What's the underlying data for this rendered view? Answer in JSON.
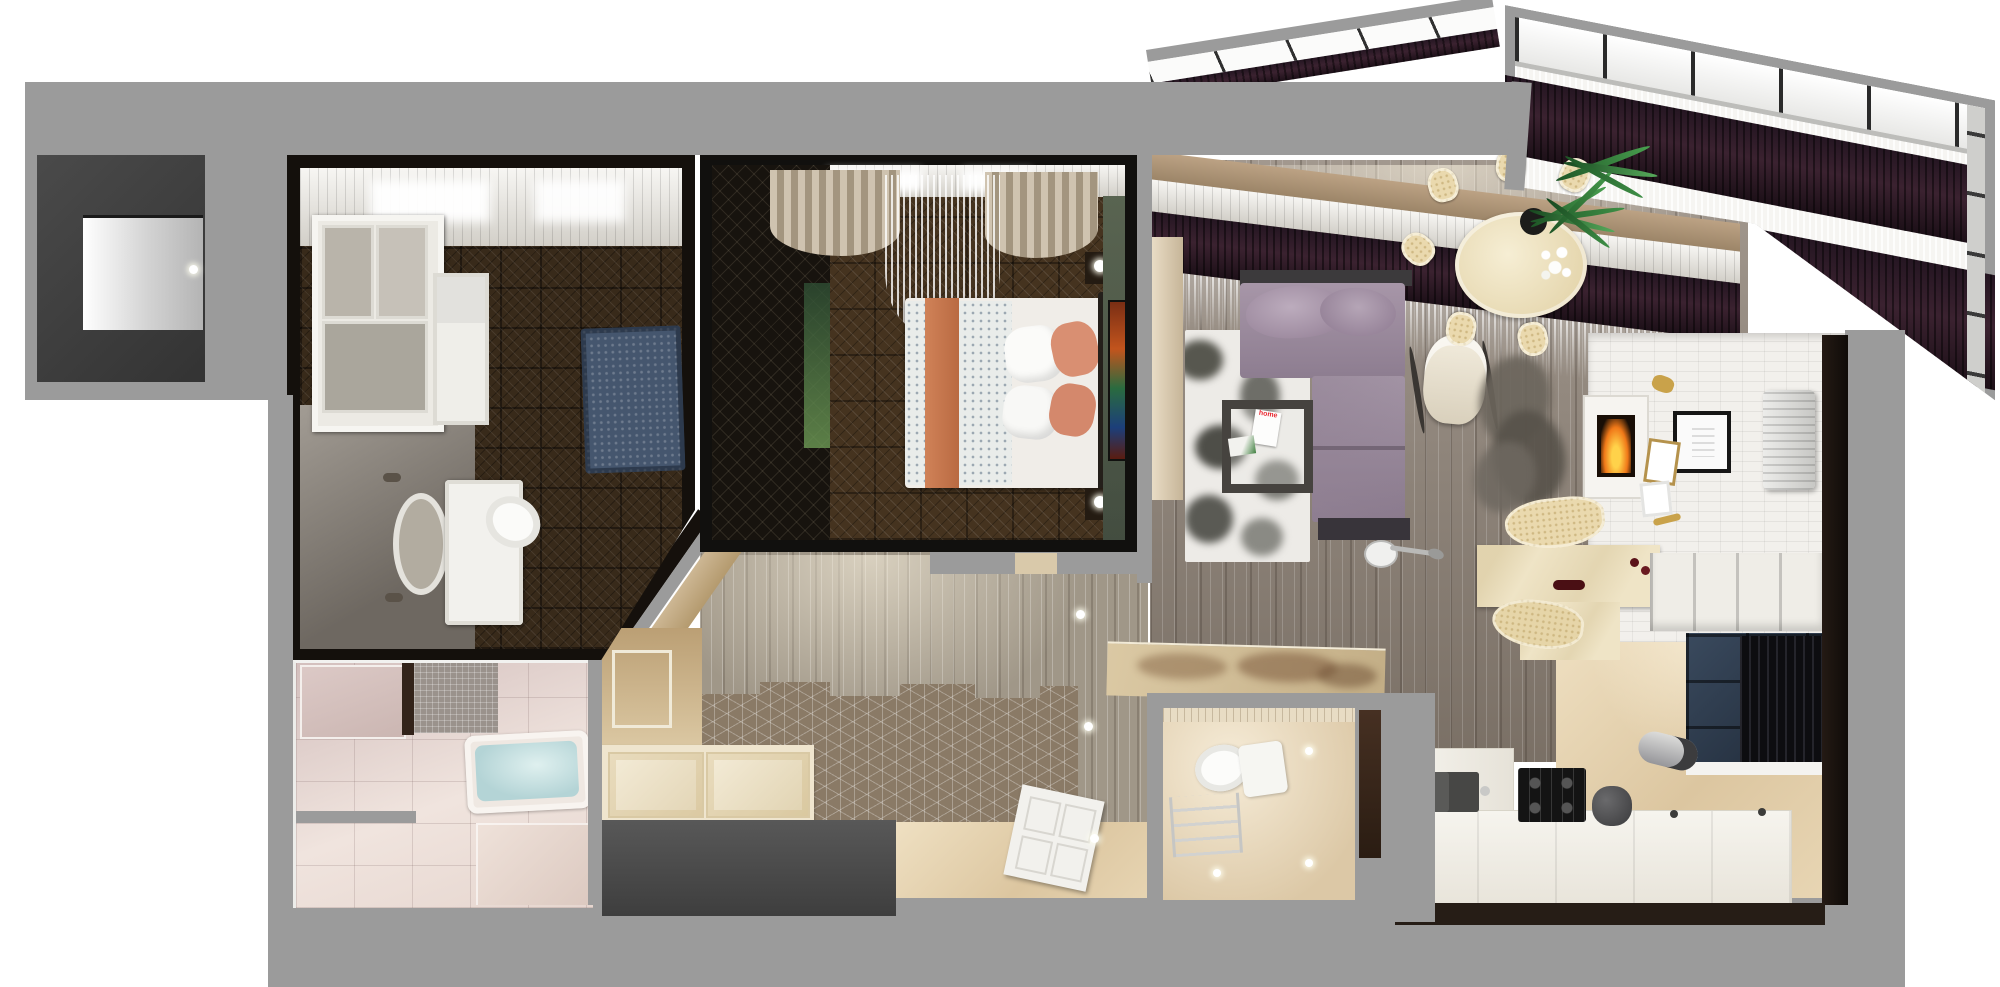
{
  "scene": {
    "type": "3d-floorplan-render",
    "view": "top-down cutaway of a one-bedroom apartment",
    "style": "photorealistic interior visualization, no UI text"
  },
  "palette": {
    "outer_wall_gray": "#9b9b9b",
    "dark_wall": "#1b1512",
    "entry_dark": "#3d3d3d",
    "plank_floor": "#8e8276",
    "dark_parquet": "#45331f",
    "hex_tile": "#8a7a66",
    "cream": "#e4d2b4",
    "pink_tile": "#e3d2cc",
    "sofa_purple": "#9a8a9c",
    "curtain_plum": "#2e1c28",
    "fire_orange": "#f07818",
    "foliage_green": "#3c8f46",
    "beige_wall": "#c9b593",
    "brick_white": "#f2f0ec",
    "water_blue": "#b9d6d8"
  },
  "rooms": [
    {
      "id": "entry",
      "label": "entry niche with lit doorway"
    },
    {
      "id": "wood-bathroom",
      "label": "bathroom-dressing room with dark wood walls",
      "furniture": [
        "white window partition",
        "white wardrobe",
        "oval mirror",
        "vanity with sink",
        "toilet",
        "dark blue rug",
        "stone accent wall"
      ]
    },
    {
      "id": "jacuzzi-bathroom",
      "label": "pink sparkle-tile bathroom",
      "furniture": [
        "jacuzzi tub with water",
        "mosaic wall patch",
        "door slot"
      ]
    },
    {
      "id": "bedroom",
      "label": "bedroom with dark walls",
      "furniture": [
        "double bed",
        "orange runner",
        "floral duvet",
        "white pillows",
        "salmon pillows",
        "dark wardrobe",
        "two nightstands",
        "cream curtains",
        "sheer curtain",
        "stained-glass art panel"
      ]
    },
    {
      "id": "hallway",
      "label": "hallway with hex-tile and plank floor",
      "furniture": [
        "built-in cream wardrobe",
        "beige paneled wall",
        "dark entrance block",
        "white door",
        "ceiling light dots",
        "console table with sepia map print"
      ]
    },
    {
      "id": "wc",
      "label": "small cream water closet",
      "furniture": [
        "toilet with tank",
        "towel ladder",
        "mosaic band",
        "door slot"
      ]
    },
    {
      "id": "living-dining",
      "label": "open living and dining room",
      "furniture": [
        "purple corner sofa",
        "black-and-white floral rug",
        "dark coffee table",
        "magazines",
        "cream rocking chair",
        "arc floor lamp",
        "gray fur rug",
        "oval cream dining table",
        "white flower centerpiece",
        "six cream chairs",
        "fireplace in white mantel",
        "black picture frame",
        "gold decor",
        "air conditioner",
        "marble bar counter",
        "two bar stools",
        "wine bottles",
        "white wall cubbies"
      ]
    },
    {
      "id": "kitchen",
      "label": "cream kitchen",
      "furniture": [
        "L-shaped white counter",
        "double gray sink",
        "black gas hob",
        "dark kettle",
        "upper cabinet band",
        "window with black curtain",
        "steel water heater"
      ]
    },
    {
      "id": "balcony",
      "label": "angled glazed balcony",
      "furniture": [
        "window glazing",
        "plum curtains",
        "sheer curtains",
        "palm plant in pot"
      ]
    }
  ],
  "living_room": {
    "magazine_title": "home"
  }
}
